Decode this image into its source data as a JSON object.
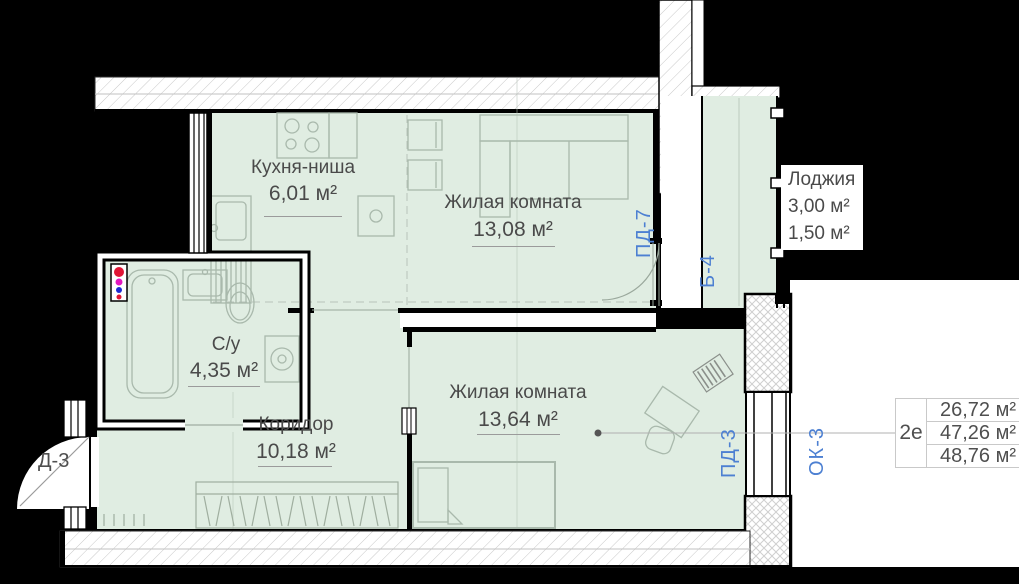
{
  "plan": {
    "rooms": [
      {
        "id": "kitchen",
        "name": "Кухня-ниша",
        "area": "6,01 м²"
      },
      {
        "id": "living1",
        "name": "Жилая комната",
        "area": "13,08 м²"
      },
      {
        "id": "living2",
        "name": "Жилая комната",
        "area": "13,64 м²"
      },
      {
        "id": "bathroom",
        "name": "С/у",
        "area": "4,35 м²"
      },
      {
        "id": "corridor",
        "name": "Коридор",
        "area": "10,18 м²"
      }
    ],
    "loggia": {
      "name": "Лоджия",
      "area_total": "3,00 м²",
      "area_reduced": "1,50 м²"
    },
    "marks": {
      "entrance_door": "Д-3",
      "loggia_door": "ПД-7",
      "loggia_glazing": "Б-4",
      "balcony_door": "ПД-3",
      "window": "ОК-3"
    }
  },
  "summary": {
    "unit": "2е",
    "areas": [
      "26,72 м²",
      "47,26 м²",
      "48,76 м²"
    ]
  },
  "colors": {
    "room_fill": "#e0ede2",
    "accent_blue": "#4d80d2",
    "text": "#4a4a4a",
    "wall": "#000000",
    "hatch": "#c9c9c9"
  }
}
